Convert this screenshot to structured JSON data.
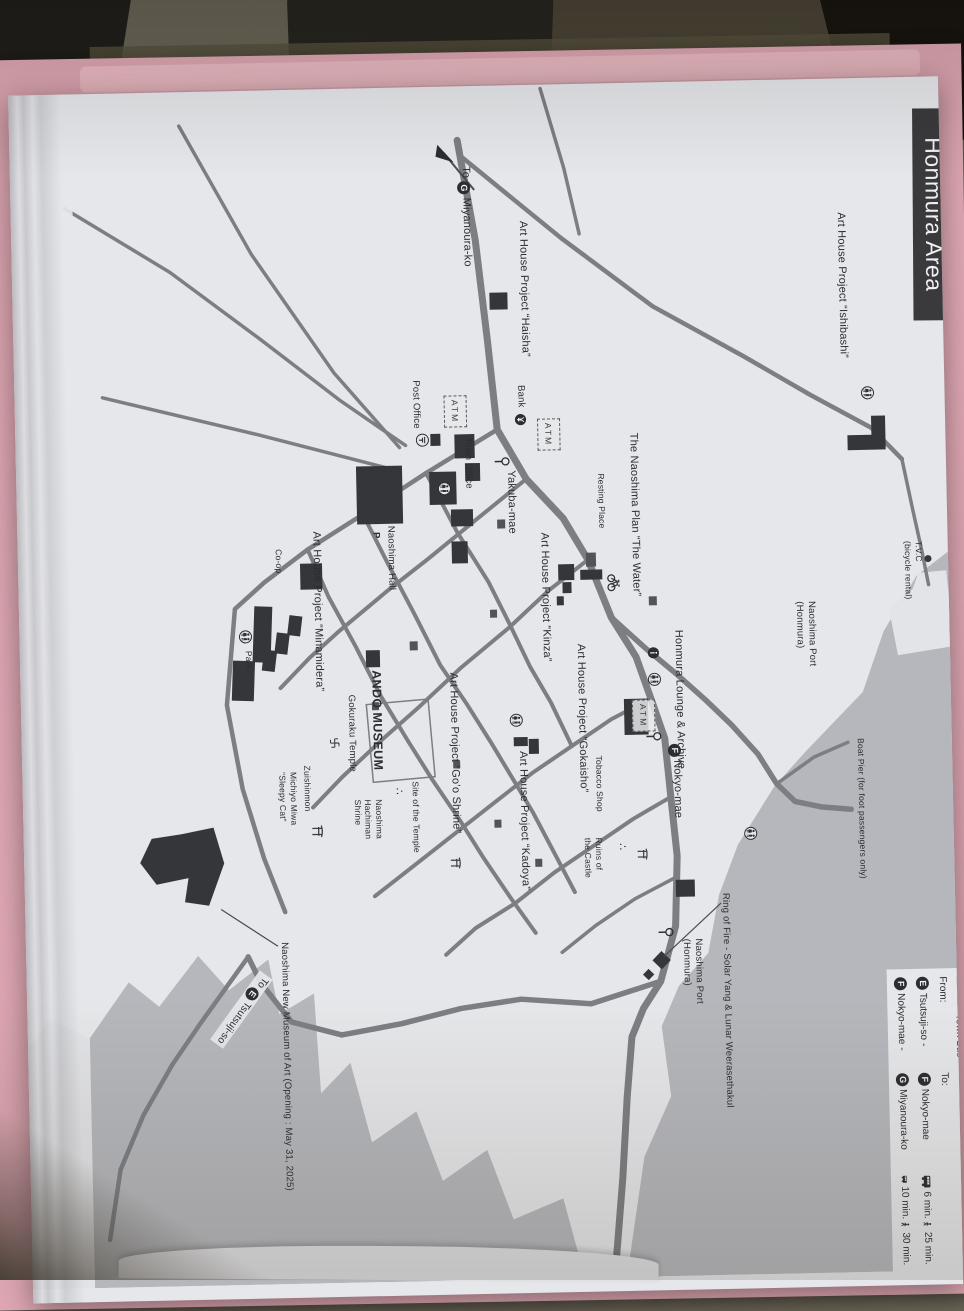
{
  "title": "Honmura Area",
  "labels": {
    "miyanoura": {
      "pre": "To",
      "letter": "G",
      "name": "Miyanoura-ko"
    },
    "tsutsuji": {
      "pre": "To",
      "letter": "E",
      "name": "Tsutsuji-so"
    },
    "nokyo": {
      "letter": "F",
      "name": "Nokyo-mae"
    },
    "ishibashi": "Art House Project “Ishibashi”",
    "haisha": "Art House Project “Haisha”",
    "post_office": "Post Office",
    "bank": "Bank",
    "atm": "ATM",
    "town_office": "Town Office",
    "yakuba": "Yakuba-mae",
    "water_plan": "The Naoshima Plan “The Water”",
    "resting": "Resting Place",
    "lounge": "Honmura Lounge & Archive",
    "gokaisho": "Art House Project “Gokaisho”",
    "kinza": "Art House Project “Kinza”",
    "tobacco": "Tobacco Shop",
    "ruins": "Ruins of\nthe Castle",
    "ruins_mark": "∴",
    "goo_shrine": "Art House Project “Go’o Shrine”",
    "kadoya": "Art House Project “Kadoya”",
    "ando": "ANDO MUSEUM",
    "minamidera": "Art House Project “Minamidera”",
    "gokuraku": "Gokuraku Temple",
    "zuishinmon": "Zuishinmon",
    "michiyo": "Michiyo Miwa\n“Sleepy Cat”",
    "site_temple": "Site of the Temple",
    "site_mark": "∴",
    "hachiman": "Naoshima\nHachiman\nShrine",
    "hall": "Naoshima Hall",
    "parking": "P",
    "coop": "Co-op",
    "park": "Park",
    "tvc": "T.V.C\n(bicycle rental)",
    "port_upper": "Naoshima Port\n(Honmura)",
    "port_lower": "Naoshima Port\n(Honmura)",
    "boat_pier": "Boat Pier (for foot passengers only)",
    "ring_of_fire": "Ring of Fire - Solar Yang & Lunar Weerasethakul",
    "new_museum": "Naoshima New Museum of Art (Opening : May 31, 2025)"
  },
  "legend": {
    "town_bus": "Town Bus",
    "from": "From:",
    "to": "To:",
    "dash": "-",
    "rows": [
      {
        "from_letter": "E",
        "from": "Tsutsuji-so",
        "to_letter": "F",
        "to": "Nokyo-mae",
        "bus": "6 min.",
        "walk": "25 min."
      },
      {
        "from_letter": "F",
        "from": "Nokyo-mae",
        "to_letter": "G",
        "to": "Miyanoura-ko",
        "bus": "10 min.",
        "walk": "30 min."
      }
    ]
  },
  "icons": {
    "wc": "restroom-icon",
    "info": "information-icon",
    "busstop": "bus-stop-icon",
    "torii": "shrine-torii-icon",
    "manji": "temple-manji-icon",
    "bicycle": "bicycle-icon",
    "bus": "bus-icon",
    "walk": "pedestrian-icon",
    "post": "post-office-icon",
    "yen": "bank-icon",
    "arrow": "direction-arrow"
  },
  "colors": {
    "paper": "#e6e7ea",
    "sea": "#b5b7bc",
    "road": "#7c7e83",
    "building": "#35363a",
    "title_bg": "#3a3a3c",
    "folder_pink": "#dda6b2"
  }
}
